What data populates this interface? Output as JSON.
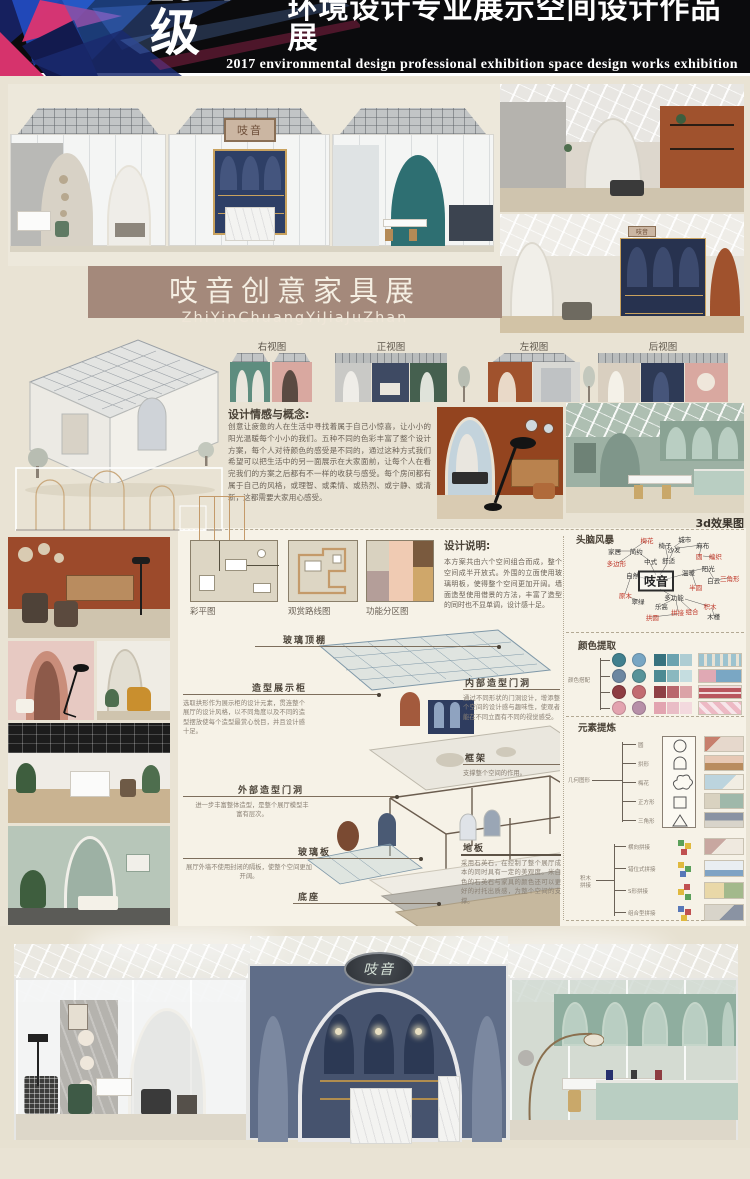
{
  "header": {
    "year": "2017级",
    "title": "环境设计专业展示空间设计作品展",
    "subtitle": "2017 environmental design professional exhibition space design works exhibition",
    "colors": {
      "bg": "#0b0b0d",
      "accent_pink": "#e8336d",
      "accent_blue": "#2350c8",
      "accent_navy": "#16205e"
    }
  },
  "banner": {
    "title": "吱音创意家具展",
    "pinyin": "ZhiYinChuangYiJiaJuZhan",
    "bg": "#a4897b"
  },
  "sign_text": "吱音",
  "views": {
    "labels": [
      "右视图",
      "正视图",
      "左视图",
      "后视图"
    ]
  },
  "concept": {
    "heading": "设计情感与概念:",
    "body": "创意让疲惫的人在生活中寻找着属于自己小惊喜，让小小的阳光温暖每个小小的我们。五种不同的色彩丰富了整个设计方案，每个人对待颜色的感受是不同的，通过这种方式我们希望可以把生活中的另一面展示在大家面前，让每个人在看完我们的方案之后都有不一样的收获与感受。每个房间都有属于自己的风格，或理智、或柔情、或热烈、或宁静、或清新，这都需要大家用心感受。"
  },
  "render_3d_label": "3d效果图",
  "plans": {
    "labels": [
      "彩平图",
      "观赏路线图",
      "功能分区图"
    ]
  },
  "design_note": {
    "heading": "设计说明:",
    "body": "本方案共由六个空间组合而成，整个空间成半开放式。外围的立面使用玻璃明板，使得整个空间更加开阔。墙面造型使用借景的方法，丰富了造型的同时也不显单调，设计感十足。"
  },
  "exploded": {
    "callouts": [
      {
        "label": "玻璃顶棚",
        "desc": ""
      },
      {
        "label": "造型展示柜",
        "desc": "选取拱形作为展示柜的设计元素，贯连整个展厅的设计风格，以不同角度以及不同的造型摆放使每个造型最赏心悦目，并且设计感十足。"
      },
      {
        "label": "外部造型门洞",
        "desc": "进一步丰富整体造型，是整个展厅模型丰富有层次。"
      },
      {
        "label": "玻璃板",
        "desc": "展厅外墙不使用封闭的隔板，使整个空间更加开阔。"
      },
      {
        "label": "底座",
        "desc": ""
      },
      {
        "label": "内部造型门洞",
        "desc": "通过不同形状的门洞设计，增添整个空间的设计感与趣味性，使观者能在不同立面有不同的视觉感受。"
      },
      {
        "label": "框架",
        "desc": "支撑整个空间的作用。"
      },
      {
        "label": "地板",
        "desc": "采用石英石，在控制了整个展厅成本的同时具有一定的美观度。米白色的石英石与家具的颜色还可以更好的衬托出质感，为整个空间的支撑。"
      }
    ]
  },
  "brainstorm": {
    "heading": "头脑风暴",
    "center": "吱音",
    "nodes": [
      {
        "t": "梅花",
        "c": "red"
      },
      {
        "t": "椅子",
        "c": "k"
      },
      {
        "t": "沙发",
        "c": "k"
      },
      {
        "t": "城市",
        "c": "k"
      },
      {
        "t": "麻布",
        "c": "k"
      },
      {
        "t": "简约",
        "c": "k"
      },
      {
        "t": "家居",
        "c": "k"
      },
      {
        "t": "多边形",
        "c": "red"
      },
      {
        "t": "中式",
        "c": "k"
      },
      {
        "t": "舒适",
        "c": "k"
      },
      {
        "t": "圆",
        "c": "red"
      },
      {
        "t": "编织",
        "c": "red"
      },
      {
        "t": "温暖",
        "c": "k"
      },
      {
        "t": "阳光",
        "c": "k"
      },
      {
        "t": "白云",
        "c": "k"
      },
      {
        "t": "三角形",
        "c": "red"
      },
      {
        "t": "半圆",
        "c": "red"
      },
      {
        "t": "自然",
        "c": "k"
      },
      {
        "t": "原木",
        "c": "red"
      },
      {
        "t": "翠绿",
        "c": "k"
      },
      {
        "t": "多功能",
        "c": "k"
      },
      {
        "t": "乐高",
        "c": "k"
      },
      {
        "t": "拼接",
        "c": "red"
      },
      {
        "t": "组合",
        "c": "red"
      },
      {
        "t": "积木",
        "c": "red"
      },
      {
        "t": "拱圆",
        "c": "red"
      },
      {
        "t": "木槿",
        "c": "k"
      }
    ]
  },
  "palette": {
    "heading": "颜色提取",
    "side_label": "颜色搭配",
    "rows": [
      {
        "c1": "#41808e",
        "c2": "#78a6c3",
        "strip": [
          "#37727e",
          "#6ba3b0",
          "#aecdd3"
        ],
        "thumb": "#9dc3cf"
      },
      {
        "c1": "#6d87a1",
        "c2": "#579399",
        "strip": [
          "#4d8a93",
          "#8ab8bf",
          "#c5dde0"
        ],
        "thumb": "#e0a9b4"
      },
      {
        "c1": "#8e3d42",
        "c2": "#c26b71",
        "strip": [
          "#8f4045",
          "#b9676d",
          "#dba3a7"
        ],
        "thumb": "#b9565e"
      },
      {
        "c1": "#e3a3af",
        "c2": "#b78fa8",
        "strip": [
          "#e2a4b0",
          "#e9bdc6",
          "#f3d9de"
        ],
        "thumb": "#edb9c4"
      }
    ]
  },
  "elements": {
    "heading": "元素提炼",
    "group1_label": "几何图形",
    "group1": [
      {
        "label": "圆",
        "shape": "circle"
      },
      {
        "label": "拱形",
        "shape": "arch"
      },
      {
        "label": "梅花",
        "shape": "blossom"
      },
      {
        "label": "正方形",
        "shape": "square"
      },
      {
        "label": "三角形",
        "shape": "triangle"
      }
    ],
    "group2_label": "积木拼接",
    "group2": [
      {
        "label": "横向拼接"
      },
      {
        "label": "错位式拼接"
      },
      {
        "label": "S形拼接"
      },
      {
        "label": "组合型拼接"
      }
    ]
  },
  "footer": {
    "school": "北海艺术设计学院——环境艺术学院",
    "names_label": "姓名：",
    "names": "侯玲玲　王晓燕　王雨楠　叶梦",
    "class_label": "班级：",
    "class_value": "环本１７１６班",
    "bg": "#2a3aa8"
  }
}
